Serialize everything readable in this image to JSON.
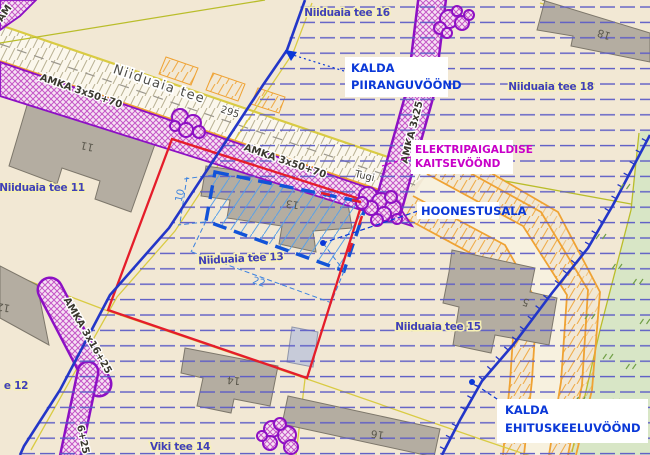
{
  "map": {
    "parcel_labels": [
      {
        "name": "parcel-label-niiduaia-tee-16",
        "text": "Niiduaia tee 16",
        "x": 347,
        "y": 16,
        "rot": 0
      },
      {
        "name": "parcel-label-niiduaia-tee-18",
        "text": "Niiduaia tee 18",
        "x": 551,
        "y": 90,
        "rot": 0
      },
      {
        "name": "parcel-label-niiduaia-tee-11",
        "text": "Niiduaia tee 11",
        "x": 42,
        "y": 191,
        "rot": 0
      },
      {
        "name": "parcel-label-niiduaia-tee-13",
        "text": "Niiduaia tee 13",
        "x": 241,
        "y": 262,
        "rot": -3
      },
      {
        "name": "parcel-label-niiduaia-tee-15",
        "text": "Niiduaia tee 15",
        "x": 438,
        "y": 330,
        "rot": 0
      },
      {
        "name": "parcel-label-niiduaia-tee-12",
        "text": "e 12",
        "x": 16,
        "y": 389,
        "rot": 0
      },
      {
        "name": "parcel-label-viki-tee-14",
        "text": "Viki tee 14",
        "x": 180,
        "y": 450,
        "rot": 0
      }
    ],
    "road_labels": [
      {
        "name": "road-label-niiduaia-tee",
        "text": "Niiduaia tee",
        "x": 158,
        "y": 88,
        "rot": 18.5
      }
    ],
    "cable_labels": [
      {
        "name": "cable-label-amka-1",
        "text": "AMKA 3x50+70",
        "x": 80,
        "y": 94,
        "rot": 19
      },
      {
        "name": "cable-label-amka-2",
        "text": "AMKA 3x50+70",
        "x": 284,
        "y": 164,
        "rot": 19
      },
      {
        "name": "cable-label-amka-3",
        "text": "AMKA 3x25",
        "x": 415,
        "y": 133,
        "rot": -76
      },
      {
        "name": "cable-label-amka-4",
        "text": "AMKA 3x16+25",
        "x": 85,
        "y": 337,
        "rot": 60
      },
      {
        "name": "cable-label-amka-5",
        "text": "6+25",
        "x": 80,
        "y": 440,
        "rot": 78
      },
      {
        "name": "cable-label-amka-6",
        "text": "AM",
        "x": 7,
        "y": 15,
        "rot": -55
      }
    ],
    "utility_labels": [
      {
        "name": "support-label-tugi",
        "text": "Tugi",
        "x": 364,
        "y": 179,
        "rot": 13
      },
      {
        "name": "road-number-295",
        "text": "295",
        "x": 229,
        "y": 115,
        "rot": 18
      }
    ],
    "building_numbers": [
      {
        "name": "building-number-11",
        "text": "11",
        "x": 88,
        "y": 143,
        "rot": 193
      },
      {
        "name": "building-number-13",
        "text": "13",
        "x": 293,
        "y": 201,
        "rot": 188
      },
      {
        "name": "building-number-14",
        "text": "14",
        "x": 234,
        "y": 377,
        "rot": 185
      },
      {
        "name": "building-number-16",
        "text": "16",
        "x": 378,
        "y": 431,
        "rot": 188
      },
      {
        "name": "building-number-18",
        "text": "18",
        "x": 605,
        "y": 31,
        "rot": 197
      },
      {
        "name": "building-number-5",
        "text": "5",
        "x": 527,
        "y": 299,
        "rot": 200
      },
      {
        "name": "building-number-12",
        "text": "12",
        "x": 4,
        "y": 304,
        "rot": 190
      }
    ],
    "dimensions": [
      {
        "name": "dimension-10",
        "text": "10",
        "x": 183,
        "y": 196,
        "rot": -78
      },
      {
        "name": "dimension-22",
        "text": "22",
        "x": 258,
        "y": 285,
        "rot": 18
      }
    ],
    "callouts": [
      {
        "name": "kalda-piiranguvoond",
        "lines": [
          "KALDA",
          "PIIRANGUVÖÖND"
        ],
        "color_key": "callout-blue"
      },
      {
        "name": "elektripaigaldise-kaitsevoond",
        "lines": [
          "ELEKTRIPAIGALDISE",
          "KAITSEVÖÖND"
        ],
        "color_key": "magenta"
      },
      {
        "name": "hoonestusala",
        "lines": [
          "HOONESTUSALA"
        ],
        "color_key": "callout-blue"
      },
      {
        "name": "kalda-ehituskeeluvoond",
        "lines": [
          "KALDA",
          "EHITUSKEELUVÖÖND"
        ],
        "color_key": "callout-blue"
      }
    ],
    "colors": {
      "beige": "#f2e8d4",
      "road-fill": "#fbf7ec",
      "band-stroke": "#8d10c4",
      "band-bg": "#f6e2f3",
      "band-hatch": "#c456c6",
      "zone-line": "#5c5cc6",
      "label-blue": "#4040b8",
      "label-halo": "#f7f1b5",
      "red": "#e51d2a",
      "hoonest-blue": "#1253d8",
      "dim-blue": "#3b82e0",
      "line-blue": "#2336c8",
      "orange": "#efa233",
      "yellow": "#d9cb43",
      "olive": "#b9bd2a",
      "green": "#d8e6c6",
      "bldg": "#b4ada1",
      "bldg-stroke": "#7d776b",
      "magenta": "#c800c8",
      "callout-blue": "#0a38d8",
      "road-hatch": "#a79f7c",
      "center-gray": "#9a968c",
      "veg-green": "#71a047"
    }
  }
}
